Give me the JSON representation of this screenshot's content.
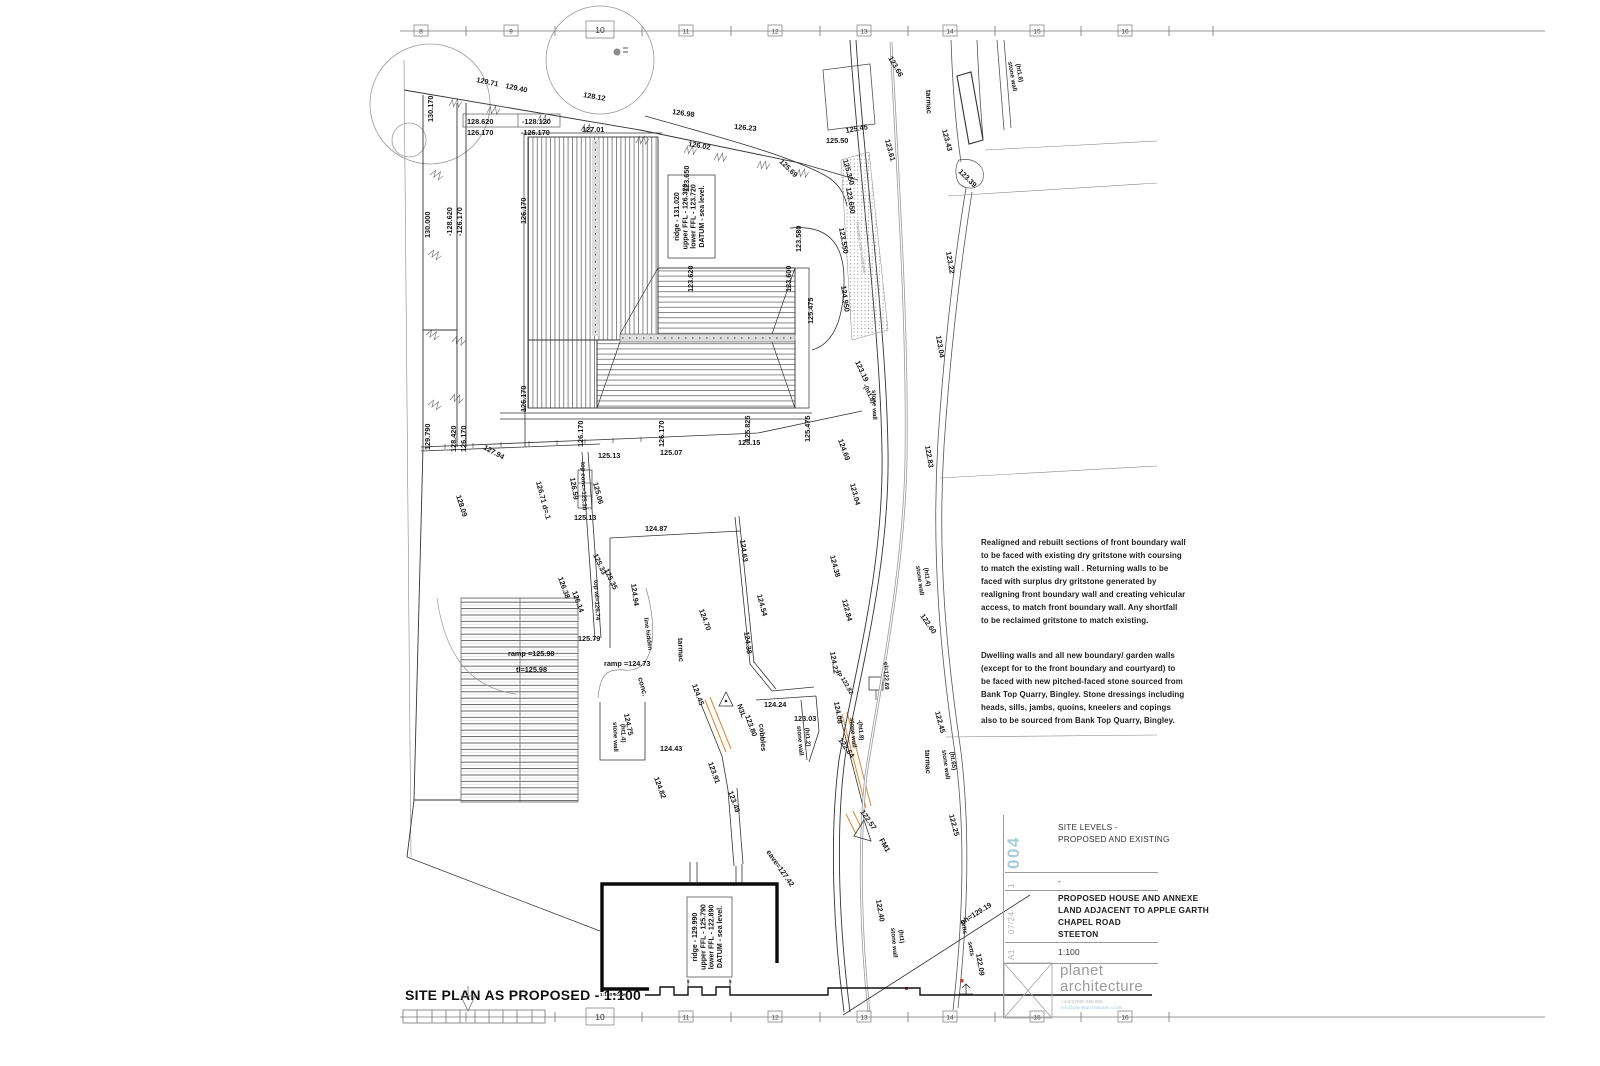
{
  "rulers": {
    "top": [
      "8",
      "9",
      "10",
      "11",
      "12",
      "13",
      "14",
      "15",
      "16"
    ],
    "bottom": [
      "10",
      "11",
      "12",
      "13",
      "14",
      "15",
      "16"
    ]
  },
  "plan": {
    "title": "SITE PLAN AS PROPOSED - 1:100",
    "scale_note": "1:100 scale"
  },
  "main_house": {
    "l1": "ridge - 131.020",
    "l2": "upper FFL - 126.320",
    "l3": "lower FFL - 123.720",
    "l4": "DATUM - sea level."
  },
  "annexe": {
    "l1": "ridge - 129.990",
    "l2": "upper FFL - 125.790",
    "l3": "lower FFL - 122.890",
    "l4": "DATUM - sea level."
  },
  "notes": {
    "para1": "Realigned and rebuilt sections of front boundary wall to be faced with existing dry gritstone with coursing to match the existing wall . Returning walls to be faced with surplus dry gritstone generated by realigning front boundary wall and creating vehicular access, to match front boundary wall. Any shortfall to be reclaimed gritstone to match existing.",
    "para2": "Dwelling walls and all new boundary/ garden walls (except for to the front boundary and courtyard) to be faced with new pitched-faced stone sourced from Bank Top Quarry, Bingley. Stone dressings including heads, sills, jambs, quoins, kneelers and copings also to be sourced from Bank Top Quarry, Bingley."
  },
  "title_block": {
    "number": "004",
    "revision": "1",
    "date": "07/24",
    "sheet": "A1",
    "title_line1": "SITE LEVELS -",
    "title_line2": "PROPOSED AND EXISTING",
    "rev_note": "-",
    "project_line1": "PROPOSED HOUSE AND ANNEXE",
    "project_line2": "LAND ADJACENT TO APPLE GARTH",
    "project_line3": "CHAPEL ROAD",
    "project_line4": "STEETON",
    "scale": "1:100",
    "logo_line1": "planet",
    "logo_line2": "architecture",
    "phone": "+44(0)7595 588 688",
    "email": "info@planetarchitecture.co.uk"
  },
  "colors": {
    "accent": "#a9ccd9",
    "highlight": "#dd8f3f"
  },
  "levels": [
    {
      "t": "130.170",
      "x": 433,
      "y": 122,
      "r": -90
    },
    {
      "t": "129.71",
      "x": 476,
      "y": 82,
      "r": 12
    },
    {
      "t": "129.40",
      "x": 505,
      "y": 88,
      "r": 12
    },
    {
      "t": "128.12",
      "x": 583,
      "y": 97,
      "r": 10
    },
    {
      "t": "126.98",
      "x": 672,
      "y": 114,
      "r": 8
    },
    {
      "t": "126.23",
      "x": 734,
      "y": 129,
      "r": 5
    },
    {
      "t": "126.02",
      "x": 688,
      "y": 146,
      "r": 10
    },
    {
      "t": "125.69",
      "x": 779,
      "y": 162,
      "r": 45
    },
    {
      "t": "125.50",
      "x": 826,
      "y": 143,
      "r": 0
    },
    {
      "t": "125.45",
      "x": 846,
      "y": 133,
      "r": -10
    },
    {
      "t": "125.350",
      "x": 843,
      "y": 160,
      "r": 75
    },
    {
      "t": "123.650",
      "x": 689,
      "y": 192,
      "r": -90
    },
    {
      "t": "123.650",
      "x": 846,
      "y": 188,
      "r": 80
    },
    {
      "t": "123.550",
      "x": 839,
      "y": 228,
      "r": 80
    },
    {
      "t": "123.580",
      "x": 801,
      "y": 252,
      "r": -90
    },
    {
      "t": "123.600",
      "x": 791,
      "y": 292,
      "r": -90
    },
    {
      "t": "123.620",
      "x": 693,
      "y": 292,
      "r": -90
    },
    {
      "t": "127.01",
      "x": 582,
      "y": 132,
      "r": 0
    },
    {
      "t": "128.620",
      "x": 467,
      "y": 124,
      "r": 0
    },
    {
      "t": "-128.120",
      "x": 522,
      "y": 124,
      "r": 0
    },
    {
      "t": "126.170",
      "x": 467,
      "y": 135,
      "r": 0
    },
    {
      "t": "-126.170",
      "x": 521,
      "y": 135,
      "r": 0
    },
    {
      "t": "130.000",
      "x": 430,
      "y": 238,
      "r": -90
    },
    {
      "t": "-128.620",
      "x": 452,
      "y": 236,
      "r": -90
    },
    {
      "t": "-126.170",
      "x": 462,
      "y": 236,
      "r": -90
    },
    {
      "t": "129.790",
      "x": 430,
      "y": 450,
      "r": -90
    },
    {
      "t": "128.420",
      "x": 456,
      "y": 452,
      "r": -90
    },
    {
      "t": "126.170",
      "x": 466,
      "y": 452,
      "r": -90
    },
    {
      "t": "126.170",
      "x": 526,
      "y": 224,
      "r": -90
    },
    {
      "t": "126.170",
      "x": 526,
      "y": 412,
      "r": -90
    },
    {
      "t": "126.170",
      "x": 583,
      "y": 447,
      "r": -90
    },
    {
      "t": "126.170",
      "x": 664,
      "y": 447,
      "r": -90
    },
    {
      "t": "125.825",
      "x": 750,
      "y": 442,
      "r": -90
    },
    {
      "t": "125.475",
      "x": 810,
      "y": 442,
      "r": -90
    },
    {
      "t": "125.475",
      "x": 813,
      "y": 324,
      "r": -90
    },
    {
      "t": "125.15",
      "x": 738,
      "y": 445,
      "r": 0
    },
    {
      "t": "125.13",
      "x": 598,
      "y": 458,
      "r": 0
    },
    {
      "t": "125.07",
      "x": 660,
      "y": 455,
      "r": 0
    },
    {
      "t": "127.94",
      "x": 483,
      "y": 449,
      "r": 28
    },
    {
      "t": "128.09",
      "x": 456,
      "y": 496,
      "r": 72
    },
    {
      "t": "126.71 d=.1",
      "x": 536,
      "y": 482,
      "r": 75
    },
    {
      "t": "top conc=125.30",
      "x": 581,
      "y": 462,
      "r": 88,
      "s": "small"
    },
    {
      "t": "126.59",
      "x": 570,
      "y": 478,
      "r": 80
    },
    {
      "t": "125.06",
      "x": 593,
      "y": 483,
      "r": 75
    },
    {
      "t": "125.13",
      "x": 574,
      "y": 520,
      "r": 0
    },
    {
      "t": "125.33",
      "x": 593,
      "y": 555,
      "r": 65
    },
    {
      "t": "125.35",
      "x": 604,
      "y": 570,
      "r": 65
    },
    {
      "t": "top wl=126.74",
      "x": 594,
      "y": 580,
      "r": 87,
      "s": "small"
    },
    {
      "t": "126.38",
      "x": 558,
      "y": 578,
      "r": 70
    },
    {
      "t": "126.14",
      "x": 572,
      "y": 592,
      "r": 70
    },
    {
      "t": "125.79",
      "x": 578,
      "y": 641,
      "r": 0
    },
    {
      "t": "124.87",
      "x": 645,
      "y": 531,
      "r": 0
    },
    {
      "t": "124.94",
      "x": 631,
      "y": 584,
      "r": 82
    },
    {
      "t": "line hidden",
      "x": 644,
      "y": 618,
      "r": 82,
      "s": "small"
    },
    {
      "t": "tarmac",
      "x": 678,
      "y": 638,
      "r": 88
    },
    {
      "t": "ramp =124.73",
      "x": 604,
      "y": 666,
      "r": 0
    },
    {
      "t": "conc.",
      "x": 638,
      "y": 678,
      "r": 75
    },
    {
      "t": "ramp =125.98",
      "x": 508,
      "y": 656,
      "r": 0
    },
    {
      "t": "tl=125.98",
      "x": 516,
      "y": 672,
      "r": 0
    },
    {
      "t": "124.70",
      "x": 699,
      "y": 610,
      "r": 70
    },
    {
      "t": "124.45",
      "x": 692,
      "y": 685,
      "r": 70
    },
    {
      "t": "124.75",
      "x": 624,
      "y": 714,
      "r": 78
    },
    {
      "t": "stone wall",
      "x": 613,
      "y": 722,
      "r": 88,
      "s": "small"
    },
    {
      "t": "(ht1.4)",
      "x": 621,
      "y": 724,
      "r": 88,
      "s": "small"
    },
    {
      "t": "124.43",
      "x": 660,
      "y": 751,
      "r": 0
    },
    {
      "t": "124.82",
      "x": 654,
      "y": 778,
      "r": 70
    },
    {
      "t": "123.91",
      "x": 708,
      "y": 763,
      "r": 70
    },
    {
      "t": "123.49",
      "x": 728,
      "y": 792,
      "r": 70
    },
    {
      "t": "N3L",
      "x": 737,
      "y": 705,
      "r": 70
    },
    {
      "t": "123.80",
      "x": 745,
      "y": 716,
      "r": 70
    },
    {
      "t": "cobbles",
      "x": 759,
      "y": 724,
      "r": 85
    },
    {
      "t": "124.24",
      "x": 764,
      "y": 707,
      "r": 0
    },
    {
      "t": "123.03",
      "x": 794,
      "y": 721,
      "r": 0
    },
    {
      "t": "stone wall",
      "x": 797,
      "y": 726,
      "r": 85,
      "s": "small"
    },
    {
      "t": "(ht1.2)",
      "x": 805,
      "y": 728,
      "r": 85,
      "s": "small"
    },
    {
      "t": "124.63",
      "x": 740,
      "y": 540,
      "r": 82
    },
    {
      "t": "124.54",
      "x": 757,
      "y": 595,
      "r": 75
    },
    {
      "t": "124.38",
      "x": 744,
      "y": 632,
      "r": 82
    },
    {
      "t": "124.38",
      "x": 830,
      "y": 556,
      "r": 75
    },
    {
      "t": "122.84",
      "x": 842,
      "y": 600,
      "r": 75
    },
    {
      "t": "123.04",
      "x": 850,
      "y": 484,
      "r": 75
    },
    {
      "t": "124.69",
      "x": 838,
      "y": 440,
      "r": 70
    },
    {
      "t": "123.19",
      "x": 855,
      "y": 362,
      "r": 65
    },
    {
      "t": "-(ht1.8)",
      "x": 863,
      "y": 385,
      "r": 65,
      "s": "small"
    },
    {
      "t": "stone wall",
      "x": 872,
      "y": 390,
      "r": 88,
      "s": "small"
    },
    {
      "t": "124.950",
      "x": 841,
      "y": 286,
      "r": 82
    },
    {
      "t": "123.61",
      "x": 885,
      "y": 140,
      "r": 75
    },
    {
      "t": "123.66",
      "x": 888,
      "y": 58,
      "r": 60
    },
    {
      "t": "122.60",
      "x": 920,
      "y": 616,
      "r": 55
    },
    {
      "t": "122.45",
      "x": 935,
      "y": 712,
      "r": 75
    },
    {
      "t": "stone wall",
      "x": 942,
      "y": 750,
      "r": 82,
      "s": "small"
    },
    {
      "t": "(ht.65)",
      "x": 950,
      "y": 752,
      "r": 82,
      "s": "small"
    },
    {
      "t": "tarmac",
      "x": 925,
      "y": 750,
      "r": 88
    },
    {
      "t": "122.25",
      "x": 949,
      "y": 815,
      "r": 75
    },
    {
      "t": "stone wall",
      "x": 916,
      "y": 566,
      "r": 82,
      "s": "small"
    },
    {
      "t": "(ht1.4)",
      "x": 924,
      "y": 568,
      "r": 82,
      "s": "small"
    },
    {
      "t": "123.43",
      "x": 942,
      "y": 130,
      "r": 75
    },
    {
      "t": "123.39",
      "x": 958,
      "y": 172,
      "r": 45
    },
    {
      "t": "123.22",
      "x": 946,
      "y": 252,
      "r": 80
    },
    {
      "t": "123.04",
      "x": 936,
      "y": 336,
      "r": 80
    },
    {
      "t": "122.83",
      "x": 925,
      "y": 446,
      "r": 80
    },
    {
      "t": "cl=122.69",
      "x": 884,
      "y": 662,
      "r": 88,
      "s": "small"
    },
    {
      "t": "122.64",
      "x": 838,
      "y": 740,
      "r": 55
    },
    {
      "t": "stone wall",
      "x": 850,
      "y": 718,
      "r": 85,
      "s": "small"
    },
    {
      "t": "-(ht1.8)",
      "x": 858,
      "y": 720,
      "r": 85,
      "s": "small"
    },
    {
      "t": "tp 122.82",
      "x": 837,
      "y": 672,
      "r": 60,
      "s": "small"
    },
    {
      "t": "124.22",
      "x": 830,
      "y": 652,
      "r": 80
    },
    {
      "t": "124.08",
      "x": 834,
      "y": 702,
      "r": 80
    },
    {
      "t": "122.57",
      "x": 860,
      "y": 812,
      "r": 55
    },
    {
      "t": "FM1",
      "x": 879,
      "y": 840,
      "r": 60
    },
    {
      "t": "122.40",
      "x": 876,
      "y": 900,
      "r": 80
    },
    {
      "t": "stone wall",
      "x": 891,
      "y": 928,
      "r": 85,
      "s": "small"
    },
    {
      "t": "(ht1)",
      "x": 899,
      "y": 930,
      "r": 85,
      "s": "small"
    },
    {
      "t": "oh=129.19",
      "x": 962,
      "y": 925,
      "r": -32
    },
    {
      "t": "122.09",
      "x": 976,
      "y": 954,
      "r": 80
    },
    {
      "t": "setts",
      "x": 961,
      "y": 920,
      "r": 80,
      "s": "small"
    },
    {
      "t": "setts",
      "x": 968,
      "y": 942,
      "r": 80,
      "s": "small"
    },
    {
      "t": "eave=127.42",
      "x": 766,
      "y": 852,
      "r": 55
    },
    {
      "t": "tarmac",
      "x": 926,
      "y": 90,
      "r": 88
    },
    {
      "t": "stone wall",
      "x": 1008,
      "y": 62,
      "r": 80,
      "s": "small"
    },
    {
      "t": "(ht1.8)",
      "x": 1016,
      "y": 64,
      "r": 80,
      "s": "small"
    },
    {
      "t": "Freestone setts to entrance",
      "x": 856,
      "y": 222,
      "r": 82,
      "s": "tiny"
    },
    {
      "t": "5",
      "x": 687,
      "y": 983,
      "r": 0,
      "s": "tiny2"
    },
    {
      "t": "5",
      "x": 729,
      "y": 983,
      "r": 0,
      "s": "tiny2"
    }
  ]
}
